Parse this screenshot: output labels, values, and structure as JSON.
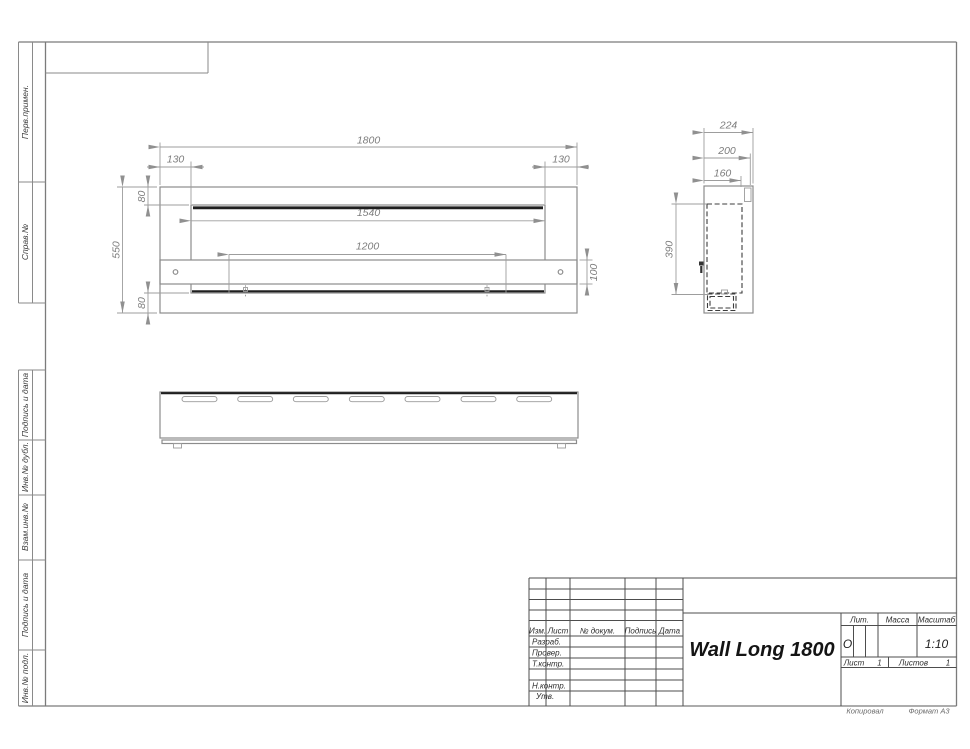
{
  "drawing": {
    "name": "Wall Long 1800",
    "scale": "1:10",
    "liter": "О",
    "sheet": "1",
    "sheets": "1"
  },
  "dims": {
    "front_width": "1800",
    "front_offset_left": "130",
    "front_offset_right": "130",
    "front_opening_width": "1540",
    "front_inner_width": "1200",
    "front_height": "550",
    "front_top_flange": "80",
    "front_bottom_flange": "80",
    "front_shelf_height": "100",
    "side_depth_overall": "224",
    "side_depth_body": "200",
    "side_depth_inner": "160",
    "side_inner_height": "390"
  },
  "margin_labels": {
    "perv_primen": "Перв.примен.",
    "sprav_no": "Справ.№",
    "podpis_data_1": "Подпись и дата",
    "inv_no_dubl": "Инв.№ дубл.",
    "vzam_inv_no": "Взам.инв.№",
    "podpis_data_2": "Подпись и дата",
    "inv_no_podl": "Инв.№ подл."
  },
  "title_block": {
    "col_izm": "Изм.",
    "col_list": "Лист",
    "col_doc": "№ докум.",
    "col_podpis": "Подпись",
    "col_data": "Дата",
    "row_razrab": "Разраб.",
    "row_prover": "Провер.",
    "row_tkontr": "Т.контр.",
    "row_nkontr": "Н.контр.",
    "row_utv": "Утв.",
    "lit_label": "Лит.",
    "massa_label": "Масса",
    "masshtab_label": "Масштаб",
    "list_label": "Лист",
    "listov_label": "Листов"
  },
  "footer": {
    "kopiroval": "Копировал",
    "format": "Формат А3"
  }
}
